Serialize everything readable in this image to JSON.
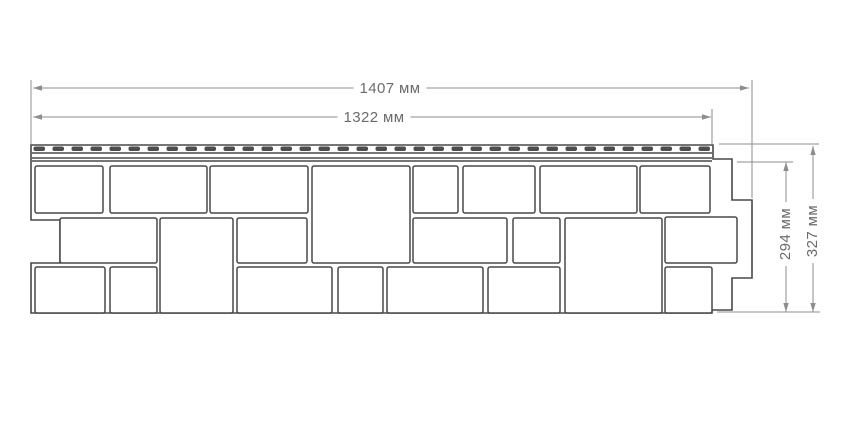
{
  "colors": {
    "background": "#ffffff",
    "panel_outline": "#484848",
    "block_fill": "#ffffff",
    "perforation_fill": "#4d4d4d",
    "dimension_line": "#8d8d8d",
    "dimension_text": "#6b6b6b"
  },
  "dimensions": [
    {
      "id": "overall-width",
      "label": "1407 мм",
      "type": "horizontal",
      "line": {
        "y": 88,
        "x1": 33,
        "x2": 749
      },
      "label_center": {
        "x": 390,
        "y": 89
      }
    },
    {
      "id": "nominal-width",
      "label": "1322 мм",
      "type": "horizontal",
      "line": {
        "y": 117,
        "x1": 33,
        "x2": 711
      },
      "label_center": {
        "x": 374,
        "y": 118
      }
    },
    {
      "id": "nominal-height",
      "label": "294 мм",
      "type": "vertical",
      "line": {
        "x": 786,
        "y1": 162,
        "y2": 312
      },
      "label_center": {
        "x": 786,
        "y": 234
      }
    },
    {
      "id": "overall-height",
      "label": "327 мм",
      "type": "vertical",
      "line": {
        "x": 813,
        "y1": 146,
        "y2": 312
      },
      "label_center": {
        "x": 813,
        "y": 231
      }
    }
  ],
  "extension_lines": [
    [
      31,
      80,
      31,
      144
    ],
    [
      712,
      109,
      712,
      144
    ],
    [
      752,
      80,
      752,
      198
    ],
    [
      719,
      144,
      819,
      144
    ],
    [
      737,
      162,
      793,
      162
    ],
    [
      717,
      312,
      820,
      312
    ]
  ],
  "panel": {
    "outline": [
      [
        31,
        145
      ],
      [
        713,
        145
      ],
      [
        713,
        159
      ],
      [
        732,
        159
      ],
      [
        732,
        200
      ],
      [
        752,
        200
      ],
      [
        752,
        278
      ],
      [
        732,
        278
      ],
      [
        732,
        310
      ],
      [
        712,
        310
      ],
      [
        712,
        313
      ],
      [
        31,
        313
      ],
      [
        31,
        263
      ],
      [
        60,
        263
      ],
      [
        60,
        220
      ],
      [
        31,
        220
      ]
    ],
    "hem": {
      "x1": 32,
      "x2": 712,
      "lines_y": [
        153,
        158,
        161
      ],
      "perforations": {
        "x_start": 33.5,
        "y": 146.5,
        "width": 11.5,
        "height": 4.5,
        "pitch": 19,
        "count": 36
      }
    },
    "blocks": [
      [
        35,
        166,
        68,
        47
      ],
      [
        110,
        166,
        97,
        47
      ],
      [
        210,
        166,
        98,
        47
      ],
      [
        413,
        166,
        45,
        47
      ],
      [
        463,
        166,
        72,
        47
      ],
      [
        540,
        166,
        97,
        47
      ],
      [
        640,
        166,
        70,
        47
      ],
      [
        312,
        166,
        98,
        97
      ],
      [
        60,
        218,
        97,
        45
      ],
      [
        160,
        218,
        73,
        95
      ],
      [
        237,
        218,
        70,
        45
      ],
      [
        413,
        218,
        94,
        45
      ],
      [
        513,
        218,
        47,
        45
      ],
      [
        565,
        218,
        97,
        95
      ],
      [
        665,
        217,
        72,
        46
      ],
      [
        35,
        267,
        70,
        46
      ],
      [
        110,
        267,
        47,
        46
      ],
      [
        237,
        267,
        95,
        46
      ],
      [
        338,
        267,
        45,
        46
      ],
      [
        387,
        267,
        96,
        46
      ],
      [
        488,
        267,
        72,
        46
      ],
      [
        665,
        267,
        47,
        46
      ]
    ]
  }
}
